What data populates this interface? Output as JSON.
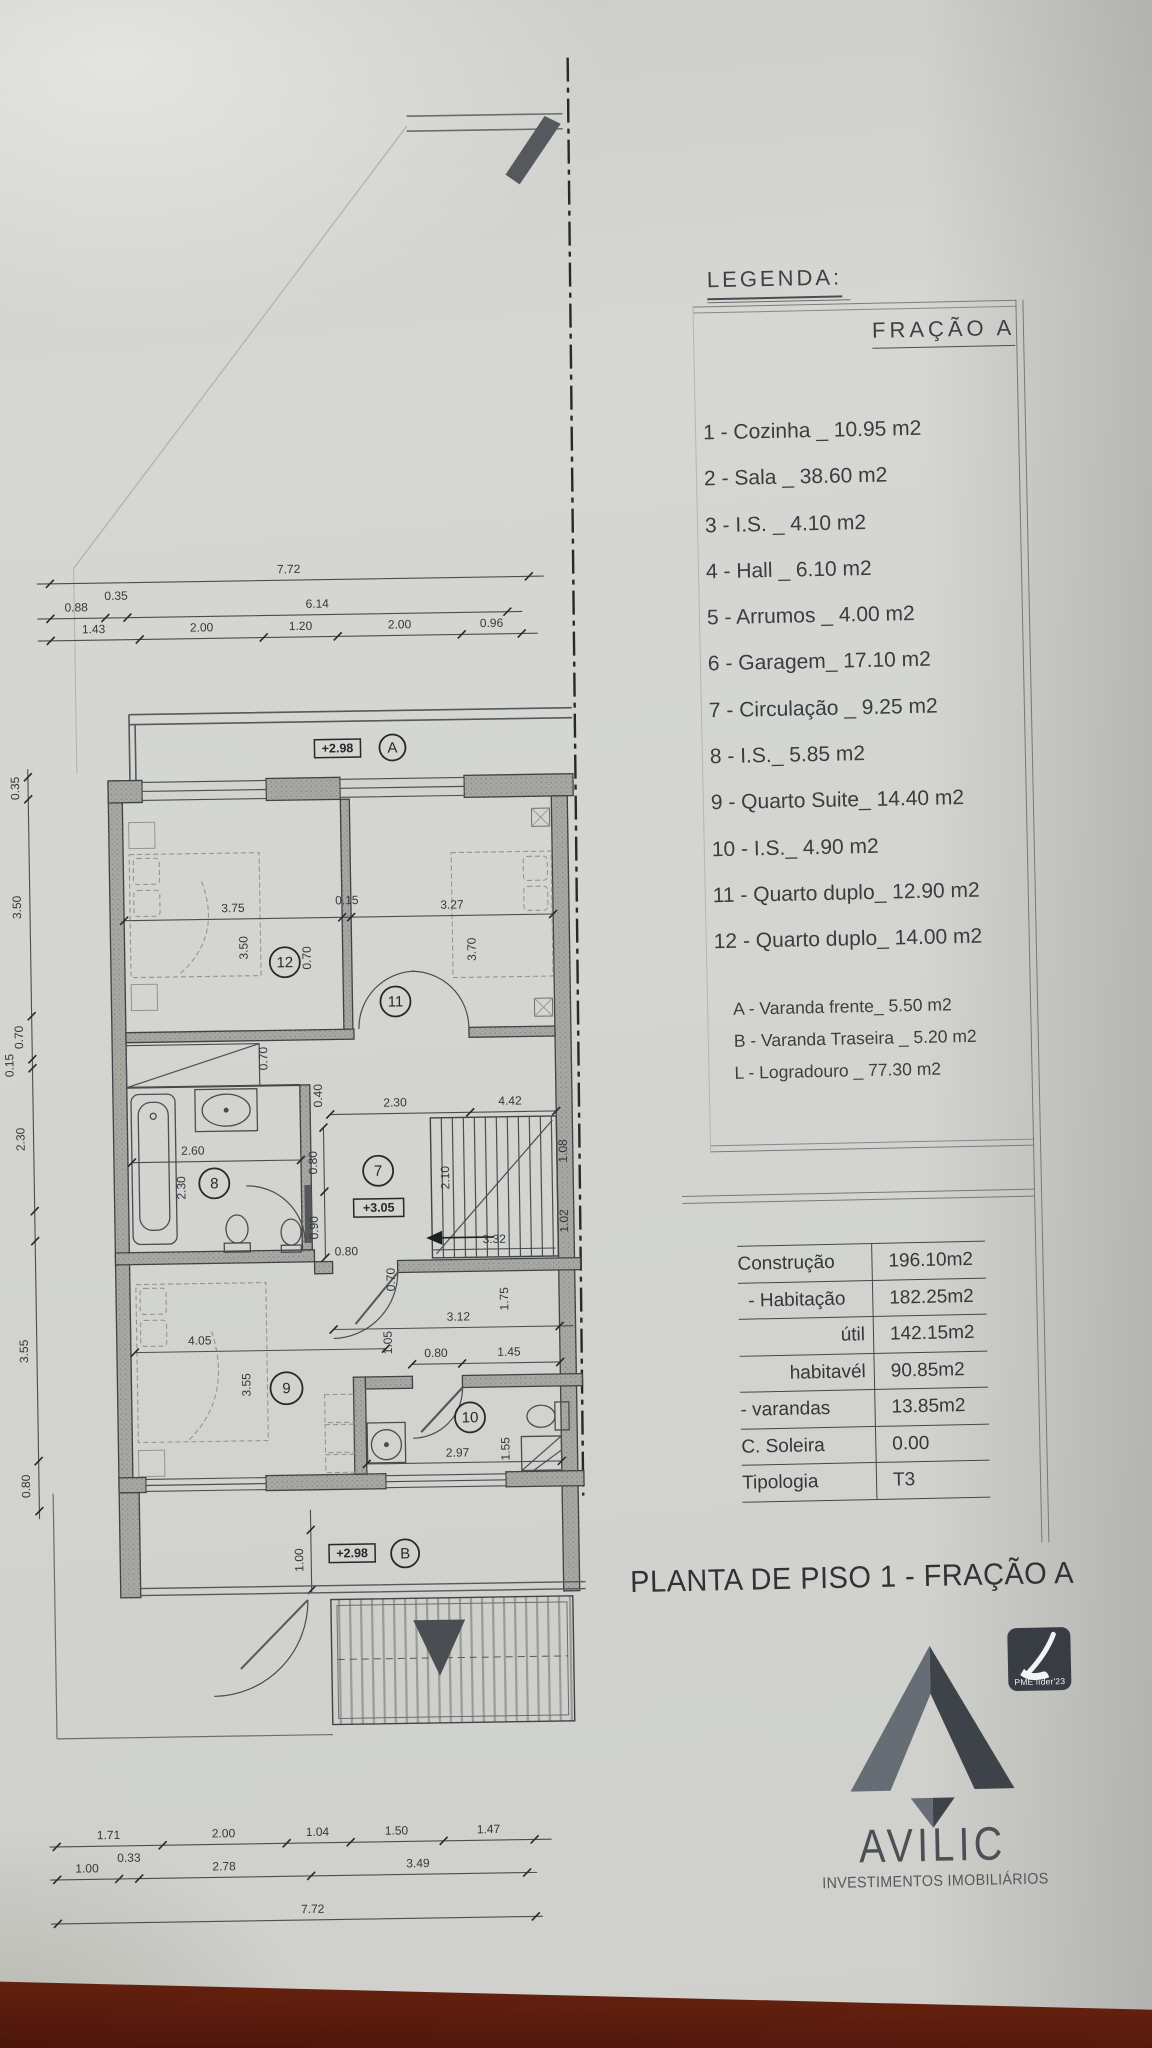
{
  "legend": {
    "heading": "LEGENDA:",
    "fraction_title": "FRAÇÃO A",
    "items": [
      "1 - Cozinha _ 10.95 m2",
      "2 - Sala  _ 38.60 m2",
      "3 - I.S. _ 4.10 m2",
      "4 - Hall _ 6.10 m2",
      "5 - Arrumos _ 4.00 m2",
      "6 - Garagem_ 17.10 m2",
      "7 - Circulação _ 9.25 m2",
      "8 - I.S._ 5.85 m2",
      "9 - Quarto Suite_ 14.40 m2",
      "10 - I.S._ 4.90 m2",
      "11 - Quarto duplo_ 12.90 m2",
      "12 - Quarto duplo_ 14.00 m2"
    ],
    "annex_items": [
      "A - Varanda frente_ 5.50 m2",
      "B - Varanda Traseira _ 5.20 m2",
      "L - Logradouro _ 77.30 m2"
    ]
  },
  "areas_table": {
    "rows": [
      {
        "label": "Construção",
        "value": "196.10m2"
      },
      {
        "label": "- Habitação",
        "value": "182.25m2"
      },
      {
        "label": "útil",
        "value": "142.15m2"
      },
      {
        "label": "habitavél",
        "value": "90.85m2"
      },
      {
        "label": "- varandas",
        "value": "13.85m2"
      },
      {
        "label": "C. Soleira",
        "value": "0.00"
      },
      {
        "label": "Tipologia",
        "value": "T3"
      }
    ]
  },
  "title": "PLANTA DE PISO 1 - FRAÇÃO A",
  "logo": {
    "name": "AVILIC",
    "subtitle": "INVESTIMENTOS IMOBILIÁRIOS",
    "badge": "PME líder'23"
  },
  "plan": {
    "rooms": {
      "r12": "12",
      "r11": "11",
      "r8": "8",
      "r7": "7",
      "r9": "9",
      "r10": "10"
    },
    "markers": {
      "a": "A",
      "b": "B"
    },
    "elevations": {
      "a": "+2.98",
      "mid": "+3.05",
      "b": "+2.98"
    },
    "dims": {
      "top_total": "7.72",
      "top2": [
        "0.88",
        "0.35",
        "6.14"
      ],
      "top3": [
        "1.43",
        "2.00",
        "1.20",
        "2.00",
        "0.96"
      ],
      "left": [
        "0.35",
        "3.50",
        "0.70",
        "0.15",
        "2.30",
        "3.55",
        "0.80"
      ],
      "bottom1": [
        "1.71",
        "2.00",
        "1.04",
        "1.50",
        "1.47"
      ],
      "bottom2": [
        "1.00",
        "0.33",
        "2.78",
        "3.49"
      ],
      "bottom_total": "7.72",
      "r12_w": "3.75",
      "r12_h": "3.50",
      "wall12_11": "0.15",
      "r11_w": "3.27",
      "r11_h": "3.70",
      "closet": "0.70",
      "nook": "0.70",
      "door_nook": "0.70",
      "bath_w": "2.60",
      "bath_h": "2.30",
      "hall_top": "2.30",
      "hall_small": "0.40",
      "hall_right": "4.42",
      "hall_v1": "0.80",
      "hall_v2": "0.90",
      "hall_bottom": "0.80",
      "stairs_w": "3.32",
      "stairs_h": "2.10",
      "stairs_r1": "1.08",
      "stairs_r2": "1.02",
      "r9_w": "4.05",
      "r9_h": "3.55",
      "below_hall": "3.12",
      "v105": "1.05",
      "v175": "1.75",
      "r10_door": "0.80",
      "r10_right": "1.45",
      "r10_w": "2.97",
      "r10_v": "1.55",
      "balc_b_h": "1.00"
    }
  }
}
